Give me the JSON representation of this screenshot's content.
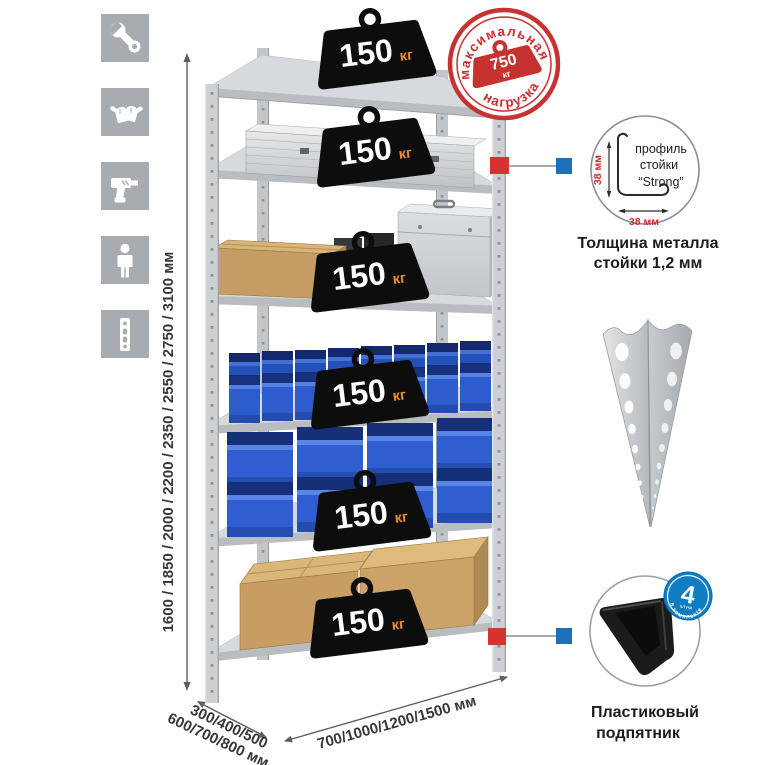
{
  "sidebar": {
    "icons": [
      {
        "name": "wrench-icon"
      },
      {
        "name": "gloves-icon"
      },
      {
        "name": "drill-icon"
      },
      {
        "name": "person-icon"
      },
      {
        "name": "rack-post-icon"
      }
    ]
  },
  "dimensions": {
    "height": "1600 / 1850 / 2000 / 2200 / 2350 / 2550 / 2750 / 3100 мм",
    "depth_line1": "300/400/500",
    "depth_line2": "600/700/800 мм",
    "width": "700/1000/1200/1500 мм"
  },
  "shelf_load": {
    "value": "150",
    "unit": "кг"
  },
  "max_load": {
    "arc_top": "максимальная",
    "arc_bottom": "нагрузка",
    "value": "750",
    "unit": "кг"
  },
  "profile_detail": {
    "label_line1": "профиль",
    "label_line2": "стойки",
    "label_line3": "“Strong”",
    "dim_vertical": "38 мм",
    "dim_horizontal": "38 мм",
    "caption_line1": "Толщина металла",
    "caption_line2": "стойки 1,2 мм"
  },
  "foot_detail": {
    "badge_number": "4",
    "badge_word": "штуки",
    "badge_arc": "в комплекте",
    "caption_line1": "Пластиковый",
    "caption_line2": "подпятник"
  },
  "colors": {
    "stamp_red": "#c5322f",
    "marker_red": "#d6332f",
    "marker_blue": "#1c70b8",
    "badge_black": "#0d0d0d",
    "badge_unit_orange": "#f28c28",
    "bin_blue": "#2d5ccc",
    "icon_gray": "#a8acb0"
  }
}
